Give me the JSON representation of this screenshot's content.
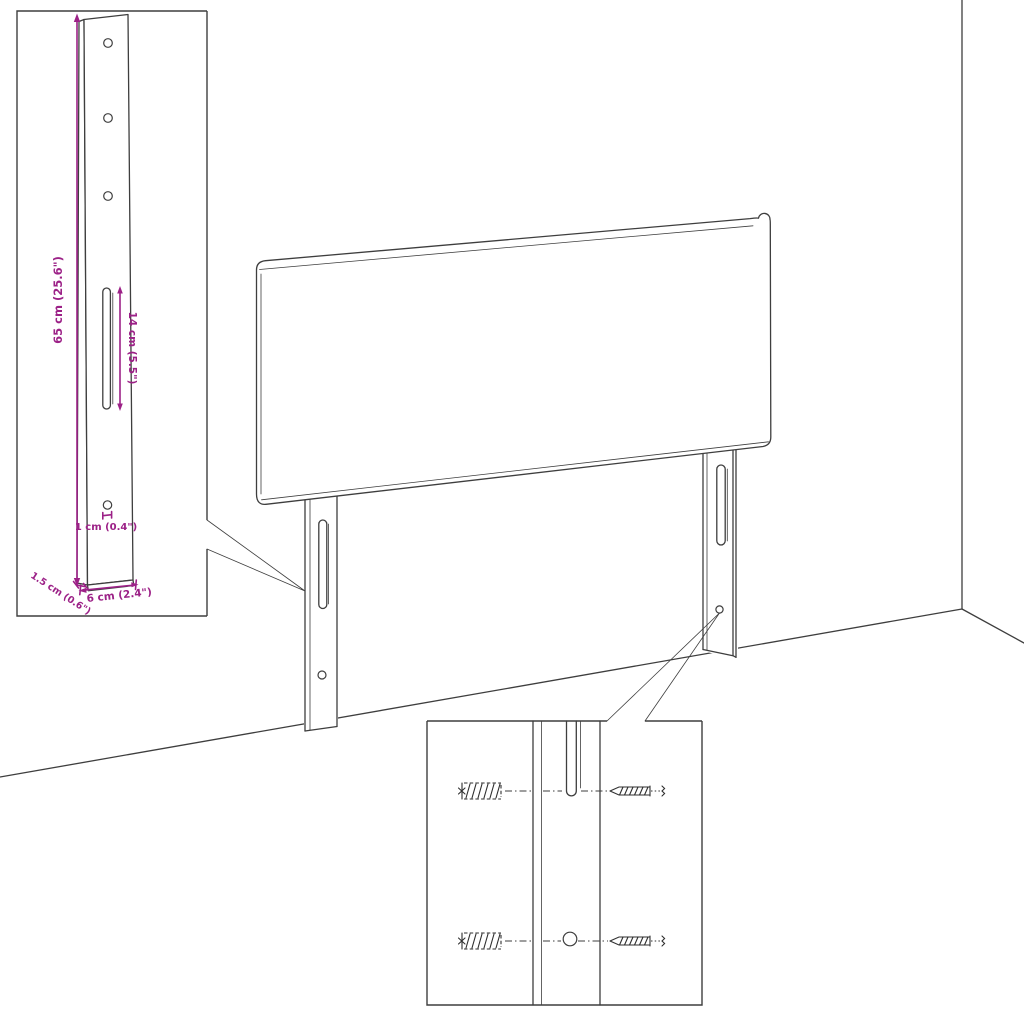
{
  "diagram": {
    "type": "product-dimension-diagram",
    "subject": "headboard with two mounting legs, wall corner backdrop, two magnified detail insets",
    "labels": {
      "post_height": "65 cm (25.6\")",
      "slot_length": "14 cm (5.5\")",
      "hole_diameter": "1 cm (0.4\")",
      "post_thickness": "1.5 cm (0.6\")",
      "post_width": "6 cm (2.4\")"
    },
    "colors": {
      "dimension": "#9c2187",
      "line": "#3e3e3e",
      "background": "#ffffff"
    }
  }
}
